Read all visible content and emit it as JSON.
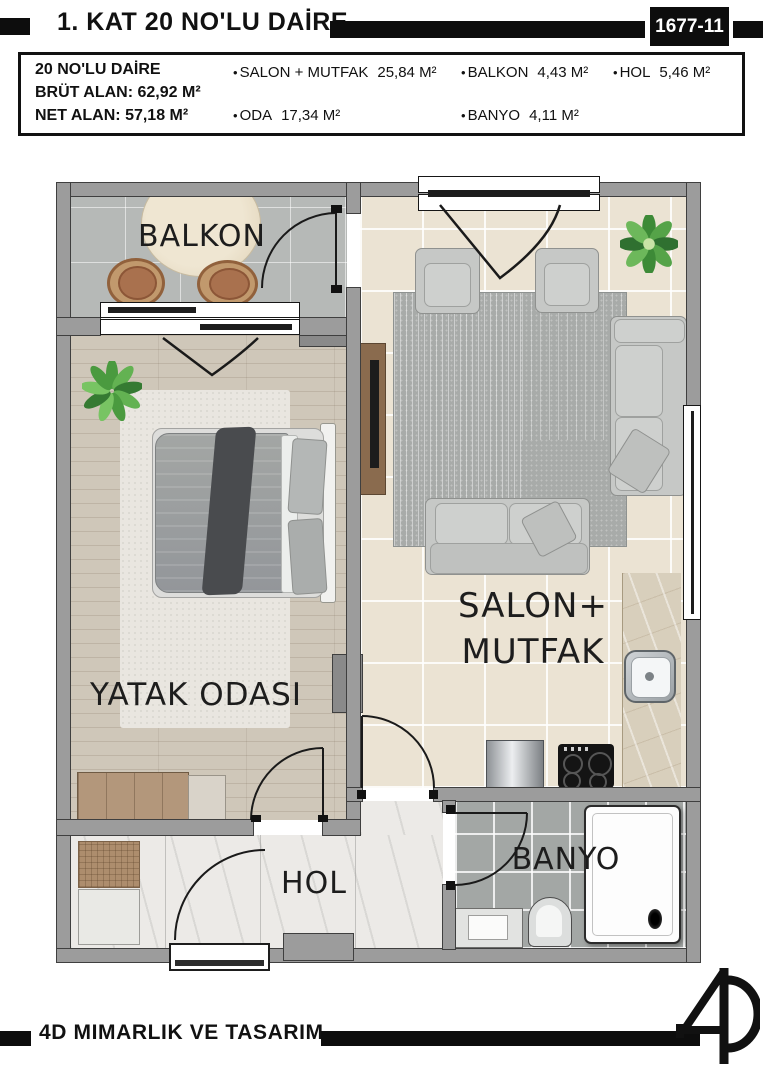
{
  "header": {
    "title": "1. KAT 20 NO'LU DAİRE",
    "sheet_no": "1677-11"
  },
  "info_box": {
    "bullet": "•",
    "apartment": "20 NO'LU DAİRE",
    "gross_area": "BRÜT ALAN: 62,92 M²",
    "net_area": "NET ALAN: 57,18 M²",
    "rooms": [
      {
        "label": "SALON + MUTFAK",
        "area": "25,84 M²"
      },
      {
        "label": "ODA",
        "area": "17,34 M²"
      },
      {
        "label": "BALKON",
        "area": "4,43 M²"
      },
      {
        "label": "BANYO",
        "area": "4,11 M²"
      },
      {
        "label": "HOL",
        "area": "5,46 M²"
      }
    ]
  },
  "plan": {
    "labels": {
      "balcony": "BALKON",
      "bedroom": "YATAK ODASI",
      "living_line1": "SALON+",
      "living_line2": "MUTFAK",
      "hall": "HOL",
      "bathroom": "BANYO"
    }
  },
  "footer": {
    "company": "4D MIMARLIK VE TASARIM"
  },
  "colors": {
    "ink": "#111111",
    "wall": "#9c9c9c",
    "salon_floor": "#ebe3d3",
    "bedroom_floor": "#cfc7b9",
    "balcony_floor": "#b6b9b7",
    "hall_floor": "#eceae7",
    "bath_floor": "#a3a7a5",
    "counter": "#d8cfbc"
  }
}
